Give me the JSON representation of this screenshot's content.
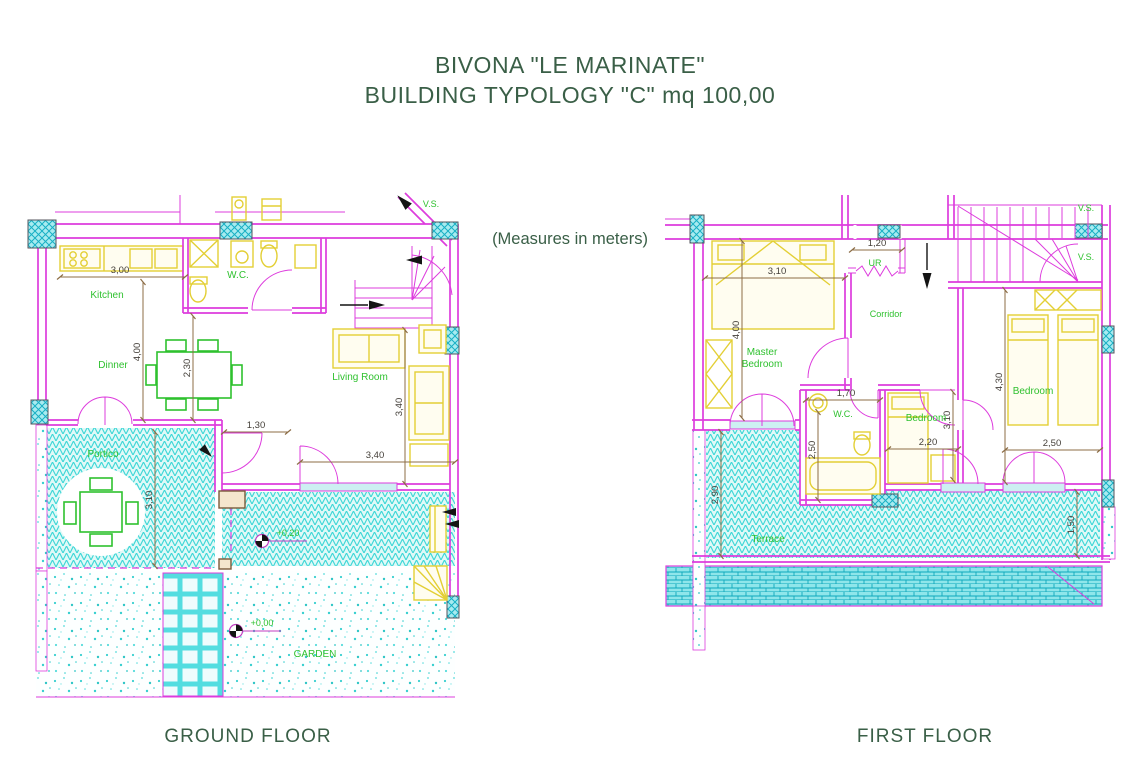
{
  "header": {
    "title_line1": "BIVONA \"LE MARINATE\"",
    "title_line2": "BUILDING TYPOLOGY \"C\" mq 100,00",
    "note": "(Measures in meters)"
  },
  "palette": {
    "wall_magenta": "#dd3cdd",
    "furniture_yellow": "#e3cf35",
    "room_label_green": "#2fc12f",
    "title_dark_green": "#3a5f47",
    "dimension_brown": "#8c6d46",
    "hatch_cyan": "#3bd6d6"
  },
  "ground_floor": {
    "caption": "GROUND FLOOR",
    "labels": {
      "vs": "V.S.",
      "kitchen": "Kitchen",
      "wc": "W.C.",
      "dinner": "Dinner",
      "living_room": "Living Room",
      "portico": "Portico",
      "garden": "GARDEN"
    },
    "dims": {
      "width_kitchen": "3,00",
      "height_room": "4,00",
      "height_dinner": "2,30",
      "height_living": "3,40",
      "width_entry_door": "1,30",
      "width_living": "3,40",
      "height_portico": "3,10",
      "level_walkway": "+0,20",
      "level_garden": "+0,00"
    }
  },
  "first_floor": {
    "caption": "FIRST FLOOR",
    "labels": {
      "vs_top": "V.S.",
      "vs_mid": "V.S.",
      "master_line1": "Master",
      "master_line2": "Bedroom",
      "ur": "UR",
      "corridor": "Corridor",
      "wc": "W.C.",
      "bedroom_center": "Bedroom",
      "bedroom_right": "Bedroom",
      "terrace": "Terrace"
    },
    "dims": {
      "width_ur": "1,20",
      "width_master": "3,10",
      "height_master": "4,00",
      "width_wc": "1,70",
      "height_wc": "2,50",
      "width_bedroom_center": "2,20",
      "height_bedroom_center": "3,10",
      "height_bedroom_right": "4,30",
      "width_bedroom_right": "2,50",
      "height_terrace": "2,90",
      "height_terrace_right": "1,50"
    }
  }
}
